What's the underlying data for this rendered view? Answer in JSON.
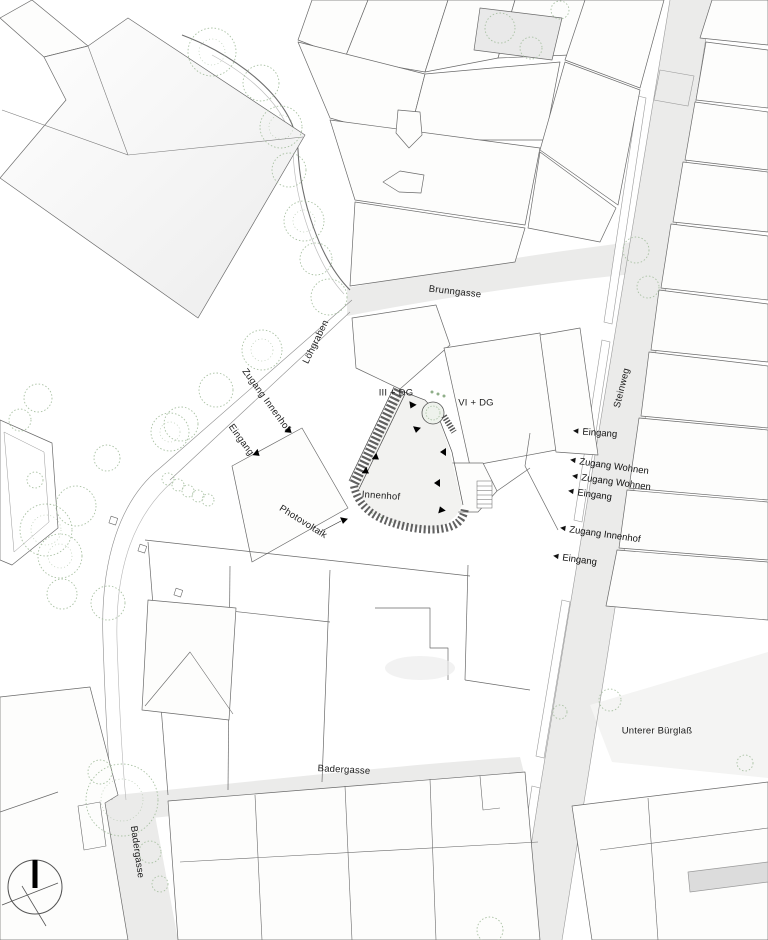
{
  "title": "Architectural site plan",
  "colors": {
    "paper": "#ffffff",
    "line": "#5f5f5f",
    "street": "#ebebea",
    "tree": "#a9c1a3",
    "hatch": "#454545",
    "shade": "#e4e4e4"
  },
  "icons": {
    "arrow_left": "◀",
    "arrow_right": "▶",
    "arrow_down": "▼",
    "north_indicator": "north-arrow"
  },
  "labels": {
    "brunngasse": "Brunngasse",
    "loehgraben": "Löhgraben",
    "zugang_innenhof_west": "Zugang Innenhof",
    "eingang_west": "Eingang",
    "floors_left": "III + DG",
    "floors_right": "VI + DG",
    "innenhof": "Innenhof",
    "photovoltaik": "Photovoltaik",
    "steinweg": "Steinweg",
    "unterer_buerglass": "Unterer Bürglaß",
    "badergasse": "Badergasse",
    "badergasse_south": "Badergasse"
  },
  "entrances_right": [
    {
      "label": "Eingang"
    },
    {
      "label": "Zugang Wohnen"
    },
    {
      "label": "Zugang Wohnen"
    },
    {
      "label": "Eingang"
    },
    {
      "label": "Zugang Innenhof"
    },
    {
      "label": "Eingang"
    }
  ]
}
